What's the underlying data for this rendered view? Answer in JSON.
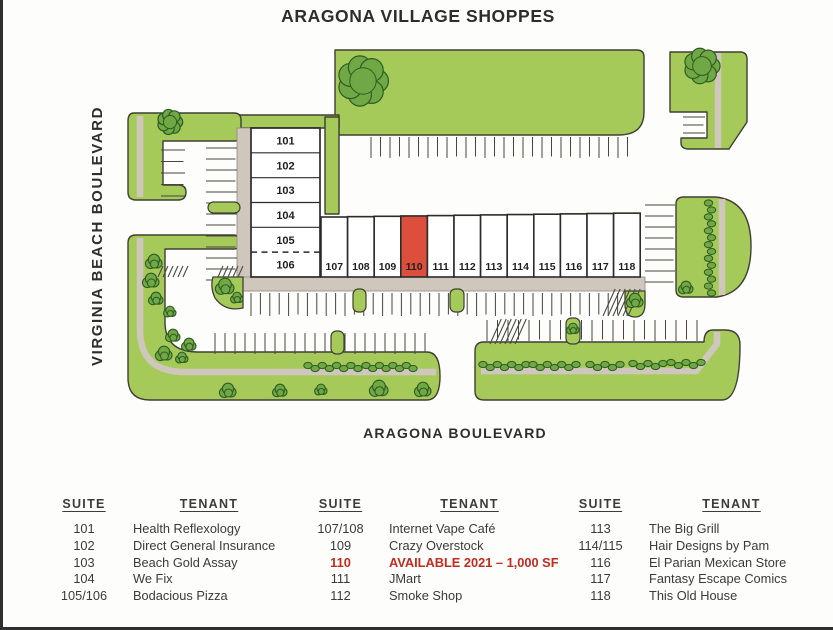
{
  "title": "ARAGONA VILLAGE SHOPPES",
  "streets": {
    "left": "VIRGINIA BEACH BOULEVARD",
    "bottom": "ARAGONA BOULEVARD"
  },
  "map": {
    "vertical_suites": [
      "101",
      "102",
      "103",
      "104",
      "105",
      "106"
    ],
    "horizontal_suites": [
      "107",
      "108",
      "109",
      "110",
      "111",
      "112",
      "113",
      "114",
      "115",
      "116",
      "117",
      "118"
    ],
    "highlighted_suite": "110",
    "colors": {
      "lawn": "#a6ca59",
      "bush_fill": "#6fa845",
      "bush_line": "#2f5c22",
      "sidewalk": "#cfc7bc",
      "outline": "#3f3f34",
      "highlight": "#dc4f3c",
      "available_text": "#c32b1f"
    }
  },
  "directory": {
    "headers": {
      "suite": "SUITE",
      "tenant": "TENANT"
    },
    "groups": [
      {
        "rows": [
          {
            "suite": "101",
            "tenant": "Health Reflexology"
          },
          {
            "suite": "102",
            "tenant": "Direct General Insurance"
          },
          {
            "suite": "103",
            "tenant": "Beach Gold Assay"
          },
          {
            "suite": "104",
            "tenant": "We Fix"
          },
          {
            "suite": "105/106",
            "tenant": "Bodacious Pizza"
          }
        ]
      },
      {
        "rows": [
          {
            "suite": "107/108",
            "tenant": "Internet Vape Café"
          },
          {
            "suite": "109",
            "tenant": "Crazy Overstock"
          },
          {
            "suite": "110",
            "tenant": "AVAILABLE 2021 – 1,000 SF",
            "available": true
          },
          {
            "suite": "111",
            "tenant": "JMart"
          },
          {
            "suite": "112",
            "tenant": "Smoke Shop"
          }
        ]
      },
      {
        "rows": [
          {
            "suite": "113",
            "tenant": "The Big Grill"
          },
          {
            "suite": "114/115",
            "tenant": "Hair Designs by Pam"
          },
          {
            "suite": "116",
            "tenant": "El Parian Mexican Store"
          },
          {
            "suite": "117",
            "tenant": "Fantasy Escape Comics"
          },
          {
            "suite": "118",
            "tenant": "This Old House"
          }
        ]
      }
    ]
  }
}
